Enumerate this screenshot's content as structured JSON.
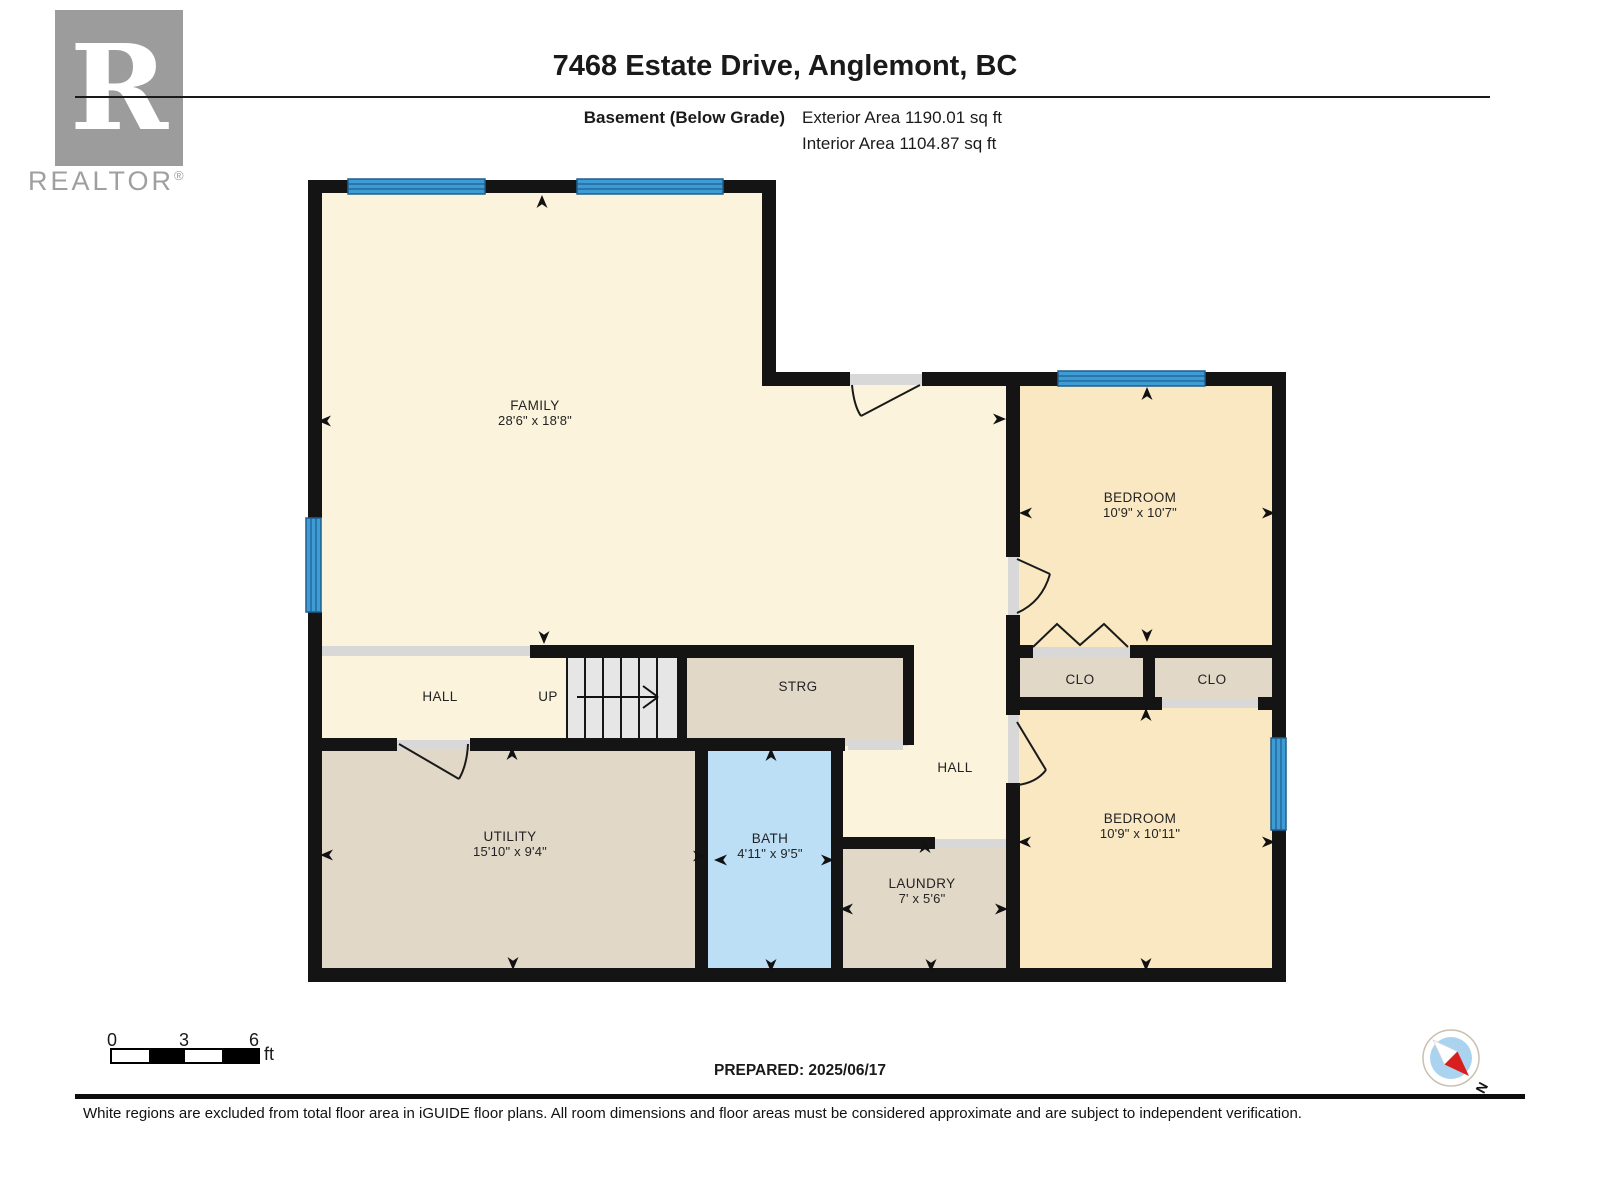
{
  "logo": {
    "letter": "R",
    "brand": "REALTOR",
    "registered": "®"
  },
  "header": {
    "title": "7468 Estate Drive, Anglemont, BC",
    "floor_label": "Basement (Below Grade)",
    "exterior_area": "Exterior Area 1190.01 sq ft",
    "interior_area": "Interior Area 1104.87 sq ft"
  },
  "rooms": {
    "family": {
      "name": "FAMILY",
      "dims": "28'6\" x 18'8\""
    },
    "bedroom_top": {
      "name": "BEDROOM",
      "dims": "10'9\" x 10'7\""
    },
    "bedroom_bottom": {
      "name": "BEDROOM",
      "dims": "10'9\" x 10'11\""
    },
    "utility": {
      "name": "UTILITY",
      "dims": "15'10\" x 9'4\""
    },
    "bath": {
      "name": "BATH",
      "dims": "4'11\" x 9'5\""
    },
    "laundry": {
      "name": "LAUNDRY",
      "dims": "7' x 5'6\""
    },
    "hall_upper": {
      "name": "HALL"
    },
    "hall_lower": {
      "name": "HALL"
    },
    "storage": {
      "name": "STRG"
    },
    "closet_left": {
      "name": "CLO"
    },
    "closet_right": {
      "name": "CLO"
    },
    "stairs": {
      "name": "UP"
    }
  },
  "scale_bar": {
    "tick0": "0",
    "tick3": "3",
    "tick6": "6",
    "unit": "ft"
  },
  "compass": {
    "north": "N"
  },
  "footer": {
    "prepared": "PREPARED: 2025/06/17",
    "disclaimer": "White regions are excluded from total floor area in iGUIDE floor plans. All room dimensions and floor areas must be considered approximate and are subject to independent verification."
  },
  "colors": {
    "wall": "#141414",
    "room_cream": "#FBF3DB",
    "room_yellow": "#F9E8C2",
    "room_tan": "#E2D8C8",
    "bath_blue": "#BCDFF6",
    "window_blue": "#3E9CD4",
    "opening_gray": "#D8D8D8",
    "logo_gray": "#9C9C9C"
  }
}
